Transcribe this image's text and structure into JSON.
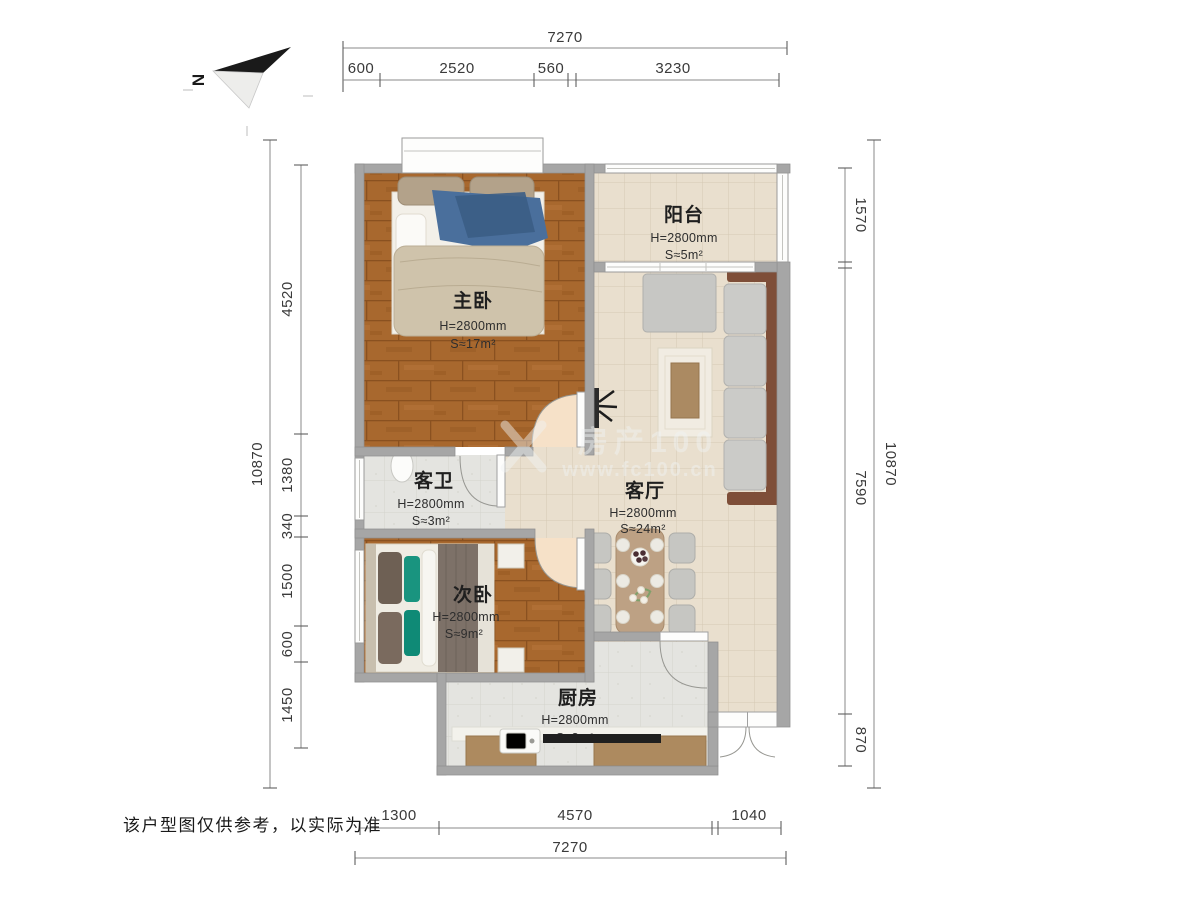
{
  "north": {
    "label": "N"
  },
  "disclaimer": {
    "text": "该户型图仅供参考，以实际为准"
  },
  "watermark": {
    "line1": "房产100",
    "line2": "www.fc100.cn"
  },
  "rooms": {
    "master": {
      "name": "主卧",
      "height": "H=2800mm",
      "area": "S≈17m²"
    },
    "balcony": {
      "name": "阳台",
      "height": "H=2800mm",
      "area": "S≈5m²"
    },
    "living": {
      "name": "客厅",
      "height": "H=2800mm",
      "area": "S≈24m²"
    },
    "bathroom": {
      "name": "客卫",
      "height": "H=2800mm",
      "area": "S≈3m²"
    },
    "bedroom2": {
      "name": "次卧",
      "height": "H=2800mm",
      "area": "S≈9m²"
    },
    "kitchen": {
      "name": "厨房",
      "height": "H=2800mm",
      "area": "S≈8m²"
    }
  },
  "dimensions": {
    "top": {
      "total": "7270",
      "segments": [
        "600",
        "2520",
        "560",
        "3230"
      ]
    },
    "bottom": {
      "total": "7270",
      "segments": [
        "1300",
        "4570",
        "1040"
      ]
    },
    "left": {
      "total": "10870",
      "segments": [
        "4520",
        "1380",
        "340",
        "1500",
        "600",
        "1450"
      ]
    },
    "right": {
      "total": "10870",
      "segments": [
        "1570",
        "7590",
        "870"
      ]
    }
  },
  "colors": {
    "wall": "#a6a6a6",
    "wood_floor": "#a8682e",
    "tile_beige": "#e9dfce",
    "tile_gray": "#e4e4e0",
    "accent_teal": "#19947f",
    "accent_blue": "#4a6f9c",
    "sofa_frame": "#7e4e38"
  }
}
